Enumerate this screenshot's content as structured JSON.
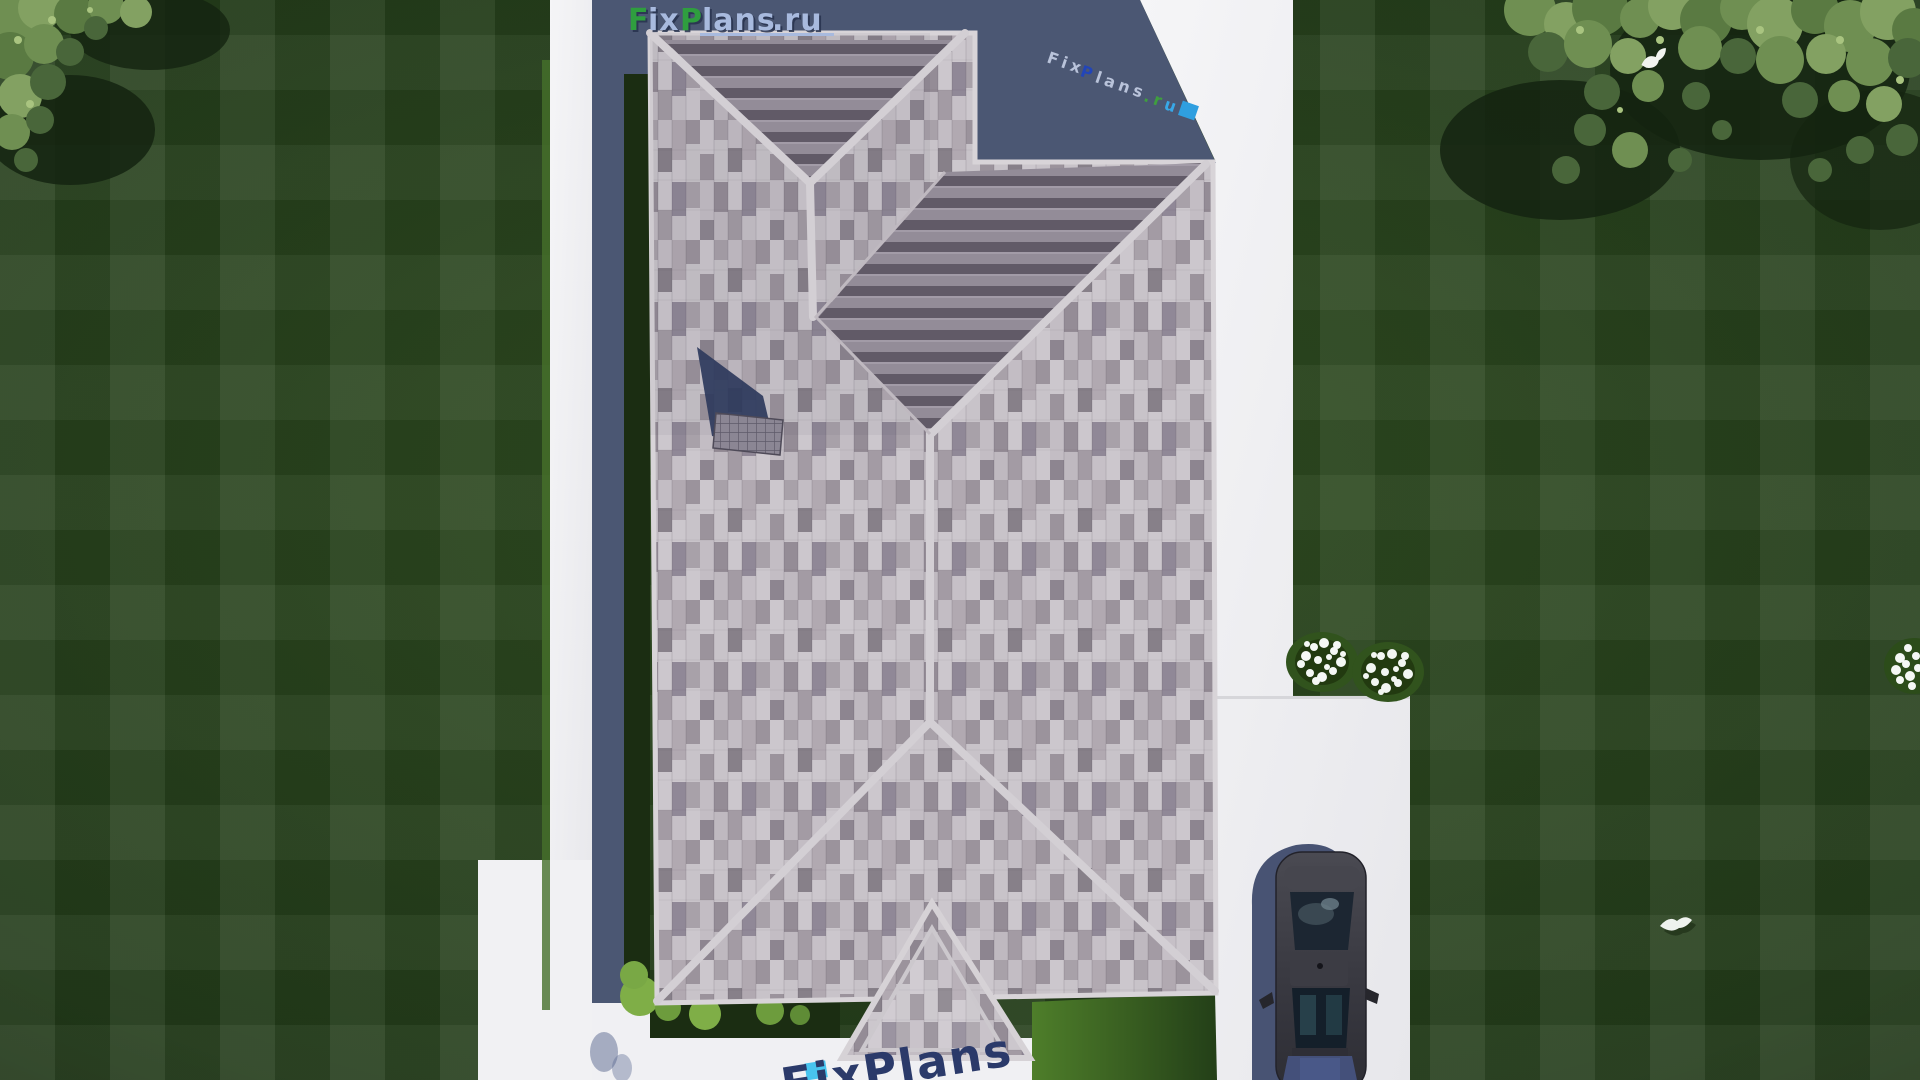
{
  "watermark_logo": {
    "f": "F",
    "ix": "ix",
    "p": "P",
    "lans": "lans",
    "ru": ".ru"
  },
  "watermark_diagonal": {
    "fix": "Fix",
    "p": "P",
    "lans": "lans",
    "r": ".r",
    "u": "u"
  },
  "watermark_bottom": {
    "text": "FixPlans"
  },
  "colors": {
    "logo_green": "#2f9e3f",
    "logo_blue": "#a8bade",
    "watermark_navy": "#2b3a6a",
    "watermark_cyan": "#3ec1ee",
    "house_shadow": "#4b5773",
    "roof_shingle_light": "#c9c4ca",
    "roof_shingle_mid": "#a29aa3",
    "roof_stripe_dark": "#615a67",
    "ridge_highlight": "#d3cfd4",
    "path_white": "#f0f0f2",
    "driveway_white": "#ececef",
    "lawn_green": "#253e1c",
    "hedge_green": "#1b2d12",
    "car_body": "#3c3c44"
  }
}
